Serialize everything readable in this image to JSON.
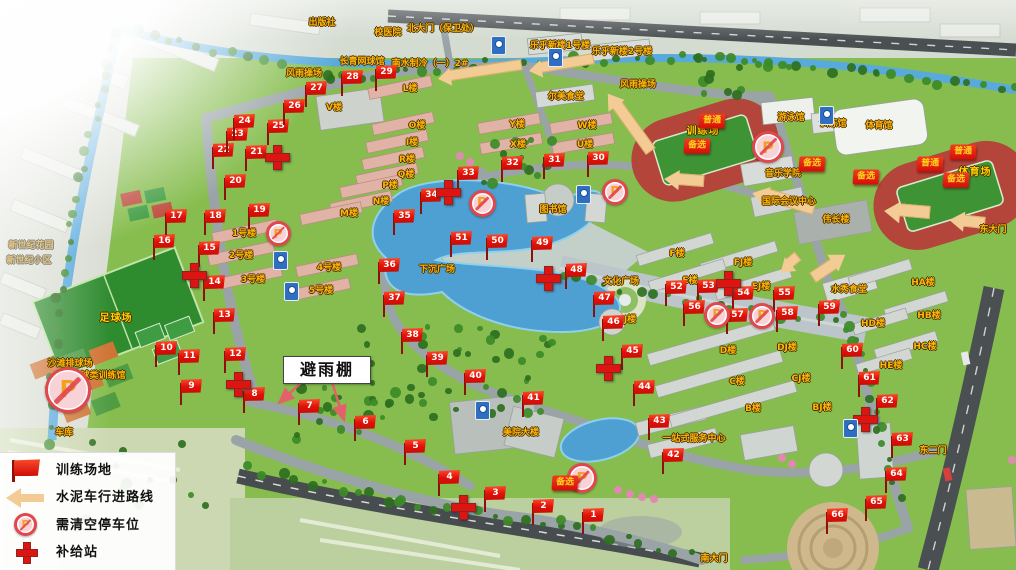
{
  "legend": {
    "items": [
      {
        "icon": "flag-icon",
        "label": "训练场地"
      },
      {
        "icon": "route-arrow-icon",
        "label": "水泥车行进路线"
      },
      {
        "icon": "no-parking-icon",
        "label": "需清空停车位"
      },
      {
        "icon": "supply-cross-icon",
        "label": "补给站"
      }
    ]
  },
  "callout": {
    "text": "避雨棚"
  },
  "icons": {
    "no_parking_glyph": "P"
  },
  "colors": {
    "flag_red": "#e01008",
    "cross_red": "#dd1410",
    "route_tan": "#f3cc95",
    "badge_red": "#d40e08",
    "badge_text": "#ffd21c",
    "label_orange": "#ffb60a",
    "water": "#58aadc",
    "track_red": "#b3453b",
    "field_green": "#3e9435",
    "road_gray": "#9aa4a7"
  },
  "flags": [
    {
      "n": "1",
      "x": 592,
      "y": 522
    },
    {
      "n": "2",
      "x": 542,
      "y": 513
    },
    {
      "n": "3",
      "x": 494,
      "y": 500
    },
    {
      "n": "4",
      "x": 448,
      "y": 484
    },
    {
      "n": "5",
      "x": 414,
      "y": 453
    },
    {
      "n": "6",
      "x": 364,
      "y": 429
    },
    {
      "n": "7",
      "x": 308,
      "y": 413
    },
    {
      "n": "8",
      "x": 253,
      "y": 401
    },
    {
      "n": "9",
      "x": 190,
      "y": 393
    },
    {
      "n": "10",
      "x": 165,
      "y": 355
    },
    {
      "n": "11",
      "x": 188,
      "y": 363
    },
    {
      "n": "12",
      "x": 234,
      "y": 361
    },
    {
      "n": "13",
      "x": 223,
      "y": 322
    },
    {
      "n": "14",
      "x": 213,
      "y": 289
    },
    {
      "n": "15",
      "x": 208,
      "y": 255
    },
    {
      "n": "16",
      "x": 163,
      "y": 248
    },
    {
      "n": "17",
      "x": 175,
      "y": 223
    },
    {
      "n": "18",
      "x": 214,
      "y": 223
    },
    {
      "n": "19",
      "x": 258,
      "y": 217
    },
    {
      "n": "20",
      "x": 234,
      "y": 188
    },
    {
      "n": "21",
      "x": 255,
      "y": 159
    },
    {
      "n": "22",
      "x": 222,
      "y": 157
    },
    {
      "n": "23",
      "x": 236,
      "y": 141
    },
    {
      "n": "24",
      "x": 243,
      "y": 128
    },
    {
      "n": "25",
      "x": 277,
      "y": 133
    },
    {
      "n": "26",
      "x": 293,
      "y": 113
    },
    {
      "n": "27",
      "x": 315,
      "y": 95
    },
    {
      "n": "28",
      "x": 351,
      "y": 84
    },
    {
      "n": "29",
      "x": 385,
      "y": 79
    },
    {
      "n": "30",
      "x": 597,
      "y": 165
    },
    {
      "n": "31",
      "x": 553,
      "y": 167
    },
    {
      "n": "32",
      "x": 511,
      "y": 170
    },
    {
      "n": "33",
      "x": 467,
      "y": 180
    },
    {
      "n": "34",
      "x": 430,
      "y": 202
    },
    {
      "n": "35",
      "x": 403,
      "y": 223
    },
    {
      "n": "36",
      "x": 388,
      "y": 272
    },
    {
      "n": "37",
      "x": 393,
      "y": 305
    },
    {
      "n": "38",
      "x": 411,
      "y": 342
    },
    {
      "n": "39",
      "x": 436,
      "y": 365
    },
    {
      "n": "40",
      "x": 474,
      "y": 383
    },
    {
      "n": "41",
      "x": 532,
      "y": 405
    },
    {
      "n": "42",
      "x": 672,
      "y": 462
    },
    {
      "n": "43",
      "x": 658,
      "y": 428
    },
    {
      "n": "44",
      "x": 643,
      "y": 394
    },
    {
      "n": "45",
      "x": 631,
      "y": 358
    },
    {
      "n": "46",
      "x": 612,
      "y": 329
    },
    {
      "n": "47",
      "x": 603,
      "y": 305
    },
    {
      "n": "48",
      "x": 575,
      "y": 277
    },
    {
      "n": "49",
      "x": 541,
      "y": 250
    },
    {
      "n": "50",
      "x": 496,
      "y": 248
    },
    {
      "n": "51",
      "x": 460,
      "y": 245
    },
    {
      "n": "52",
      "x": 675,
      "y": 294
    },
    {
      "n": "53",
      "x": 707,
      "y": 293
    },
    {
      "n": "54",
      "x": 742,
      "y": 300
    },
    {
      "n": "55",
      "x": 783,
      "y": 300
    },
    {
      "n": "56",
      "x": 693,
      "y": 314
    },
    {
      "n": "57",
      "x": 736,
      "y": 322
    },
    {
      "n": "58",
      "x": 786,
      "y": 320
    },
    {
      "n": "59",
      "x": 828,
      "y": 314
    },
    {
      "n": "60",
      "x": 851,
      "y": 357
    },
    {
      "n": "61",
      "x": 868,
      "y": 385
    },
    {
      "n": "62",
      "x": 886,
      "y": 408
    },
    {
      "n": "63",
      "x": 901,
      "y": 446
    },
    {
      "n": "64",
      "x": 895,
      "y": 481
    },
    {
      "n": "65",
      "x": 875,
      "y": 509
    },
    {
      "n": "66",
      "x": 836,
      "y": 522
    }
  ],
  "supply_stations": [
    {
      "x": 277,
      "y": 157
    },
    {
      "x": 194,
      "y": 275
    },
    {
      "x": 238,
      "y": 384
    },
    {
      "x": 448,
      "y": 192
    },
    {
      "x": 548,
      "y": 278
    },
    {
      "x": 728,
      "y": 283
    },
    {
      "x": 608,
      "y": 368
    },
    {
      "x": 865,
      "y": 419
    },
    {
      "x": 463,
      "y": 507
    }
  ],
  "no_parking": [
    {
      "x": 68,
      "y": 390,
      "s": 46
    },
    {
      "x": 278,
      "y": 233,
      "s": 25
    },
    {
      "x": 482,
      "y": 203,
      "s": 27
    },
    {
      "x": 615,
      "y": 192,
      "s": 26
    },
    {
      "x": 768,
      "y": 147,
      "s": 32
    },
    {
      "x": 717,
      "y": 315,
      "s": 26
    },
    {
      "x": 762,
      "y": 316,
      "s": 26
    },
    {
      "x": 582,
      "y": 478,
      "s": 30
    }
  ],
  "badges": [
    {
      "text": "普通",
      "x": 712,
      "y": 121
    },
    {
      "text": "备选",
      "x": 697,
      "y": 146
    },
    {
      "text": "备选",
      "x": 812,
      "y": 164
    },
    {
      "text": "备选",
      "x": 866,
      "y": 177
    },
    {
      "text": "普通",
      "x": 930,
      "y": 164
    },
    {
      "text": "普通",
      "x": 963,
      "y": 152
    },
    {
      "text": "备选",
      "x": 956,
      "y": 180
    },
    {
      "text": "备选",
      "x": 565,
      "y": 483
    }
  ],
  "route_arrows": [
    {
      "x1": 522,
      "y1": 66,
      "x2": 437,
      "y2": 79,
      "w": 9
    },
    {
      "x1": 594,
      "y1": 60,
      "x2": 528,
      "y2": 71,
      "w": 9
    },
    {
      "x1": 650,
      "y1": 152,
      "x2": 608,
      "y2": 94,
      "w": 10
    },
    {
      "x1": 704,
      "y1": 182,
      "x2": 664,
      "y2": 179,
      "w": 10
    },
    {
      "x1": 814,
      "y1": 210,
      "x2": 752,
      "y2": 192,
      "w": 11
    },
    {
      "x1": 930,
      "y1": 214,
      "x2": 884,
      "y2": 210,
      "w": 11
    },
    {
      "x1": 985,
      "y1": 224,
      "x2": 949,
      "y2": 220,
      "w": 10
    },
    {
      "x1": 812,
      "y1": 277,
      "x2": 845,
      "y2": 255,
      "w": 10
    },
    {
      "x1": 799,
      "y1": 257,
      "x2": 780,
      "y2": 273,
      "w": 9
    }
  ],
  "sign_boards": [
    {
      "x": 497,
      "y": 45
    },
    {
      "x": 554,
      "y": 57
    },
    {
      "x": 825,
      "y": 115
    },
    {
      "x": 279,
      "y": 260
    },
    {
      "x": 290,
      "y": 291
    },
    {
      "x": 582,
      "y": 194
    },
    {
      "x": 849,
      "y": 428
    },
    {
      "x": 481,
      "y": 410
    }
  ],
  "labels": [
    {
      "t": "出版社",
      "x": 322,
      "y": 23
    },
    {
      "t": "校医院",
      "x": 388,
      "y": 33
    },
    {
      "t": "北大门（保卫处）",
      "x": 443,
      "y": 29
    },
    {
      "t": "长青网球馆",
      "x": 362,
      "y": 62
    },
    {
      "t": "南水制冷（一）2#",
      "x": 430,
      "y": 64
    },
    {
      "t": "风雨操场",
      "x": 304,
      "y": 74
    },
    {
      "t": "乐乎新楼1号楼",
      "x": 560,
      "y": 46
    },
    {
      "t": "乐乎新楼2号楼",
      "x": 622,
      "y": 52
    },
    {
      "t": "尔美食堂",
      "x": 566,
      "y": 97
    },
    {
      "t": "风雨操场",
      "x": 638,
      "y": 85
    },
    {
      "t": "游泳馆",
      "x": 791,
      "y": 118
    },
    {
      "t": "训练馆",
      "x": 833,
      "y": 124
    },
    {
      "t": "体育馆",
      "x": 879,
      "y": 126
    },
    {
      "t": "训练场",
      "x": 703,
      "y": 132,
      "c": "big"
    },
    {
      "t": "体育场",
      "x": 975,
      "y": 173,
      "c": "big"
    },
    {
      "t": "音乐学院",
      "x": 783,
      "y": 174
    },
    {
      "t": "国际会议中心",
      "x": 789,
      "y": 202
    },
    {
      "t": "伟长楼",
      "x": 836,
      "y": 220
    },
    {
      "t": "图书馆",
      "x": 553,
      "y": 210
    },
    {
      "t": "下沉广场",
      "x": 437,
      "y": 270
    },
    {
      "t": "文化广场",
      "x": 621,
      "y": 282
    },
    {
      "t": "水秀食堂",
      "x": 849,
      "y": 290
    },
    {
      "t": "足球场",
      "x": 116,
      "y": 319,
      "c": "big"
    },
    {
      "t": "沙滩排球场",
      "x": 70,
      "y": 364
    },
    {
      "t": "球类训练馆",
      "x": 103,
      "y": 376
    },
    {
      "t": "车库",
      "x": 64,
      "y": 433
    },
    {
      "t": "美院大楼",
      "x": 521,
      "y": 433
    },
    {
      "t": "一站式服务中心",
      "x": 694,
      "y": 439
    },
    {
      "t": "南大门",
      "x": 714,
      "y": 559
    },
    {
      "t": "东大门",
      "x": 993,
      "y": 230
    },
    {
      "t": "东二门",
      "x": 933,
      "y": 451
    },
    {
      "t": "新世纪花园",
      "x": 31,
      "y": 246,
      "c": "muted"
    },
    {
      "t": "新世纪小区",
      "x": 29,
      "y": 261,
      "c": "muted"
    },
    {
      "t": "V楼",
      "x": 334,
      "y": 108
    },
    {
      "t": "L楼",
      "x": 410,
      "y": 89
    },
    {
      "t": "O楼",
      "x": 417,
      "y": 126
    },
    {
      "t": "I楼",
      "x": 412,
      "y": 143
    },
    {
      "t": "R楼",
      "x": 407,
      "y": 160
    },
    {
      "t": "Q楼",
      "x": 406,
      "y": 175
    },
    {
      "t": "P楼",
      "x": 390,
      "y": 186
    },
    {
      "t": "N楼",
      "x": 381,
      "y": 202
    },
    {
      "t": "M楼",
      "x": 349,
      "y": 214
    },
    {
      "t": "Y楼",
      "x": 517,
      "y": 125
    },
    {
      "t": "W楼",
      "x": 587,
      "y": 126
    },
    {
      "t": "X楼",
      "x": 518,
      "y": 145
    },
    {
      "t": "U楼",
      "x": 585,
      "y": 145
    },
    {
      "t": "1号楼",
      "x": 244,
      "y": 234
    },
    {
      "t": "2号楼",
      "x": 241,
      "y": 256
    },
    {
      "t": "3号楼",
      "x": 253,
      "y": 280
    },
    {
      "t": "4号楼",
      "x": 329,
      "y": 268
    },
    {
      "t": "5号楼",
      "x": 321,
      "y": 291
    },
    {
      "t": "F楼",
      "x": 677,
      "y": 254
    },
    {
      "t": "FJ楼",
      "x": 743,
      "y": 263
    },
    {
      "t": "E楼",
      "x": 690,
      "y": 281
    },
    {
      "t": "EJ楼",
      "x": 761,
      "y": 287
    },
    {
      "t": "J楼",
      "x": 630,
      "y": 320
    },
    {
      "t": "D楼",
      "x": 728,
      "y": 351
    },
    {
      "t": "DJ楼",
      "x": 787,
      "y": 348
    },
    {
      "t": "C楼",
      "x": 737,
      "y": 382
    },
    {
      "t": "CJ楼",
      "x": 801,
      "y": 379
    },
    {
      "t": "B楼",
      "x": 753,
      "y": 409
    },
    {
      "t": "BJ楼",
      "x": 822,
      "y": 408
    },
    {
      "t": "HA楼",
      "x": 923,
      "y": 283
    },
    {
      "t": "HD楼",
      "x": 873,
      "y": 324
    },
    {
      "t": "HB楼",
      "x": 929,
      "y": 316
    },
    {
      "t": "HC楼",
      "x": 925,
      "y": 347
    },
    {
      "t": "HE楼",
      "x": 891,
      "y": 366
    }
  ]
}
